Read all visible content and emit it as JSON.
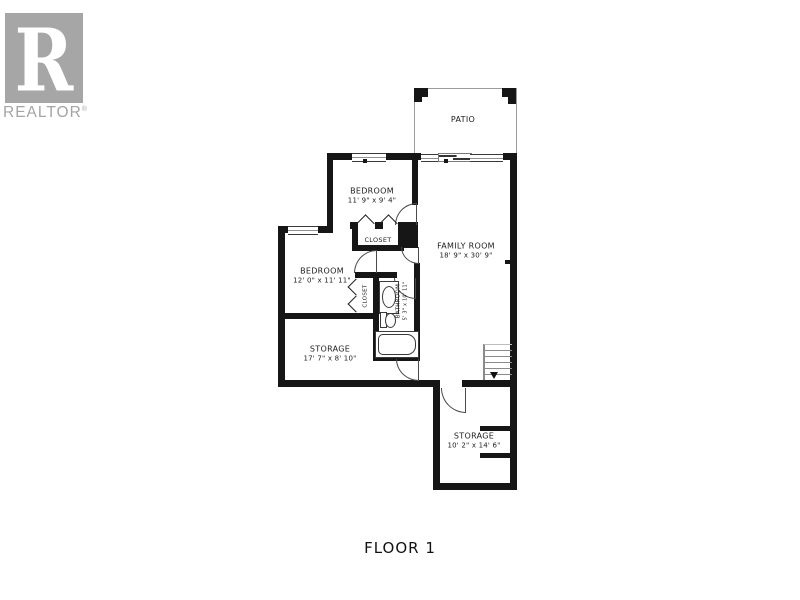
{
  "logo": {
    "letter": "R",
    "brand": "REALTOR",
    "registered": "®"
  },
  "plan": {
    "floor_label": "FLOOR 1",
    "rooms": {
      "patio": {
        "name": "PATIO",
        "dims": ""
      },
      "bedroom_top": {
        "name": "BEDROOM",
        "dims": "11' 9\" x 9' 4\""
      },
      "family_room": {
        "name": "FAMILY ROOM",
        "dims": "18' 9\" x 30' 9\""
      },
      "closet_hall": {
        "name": "CLOSET",
        "dims": ""
      },
      "bedroom_left": {
        "name": "BEDROOM",
        "dims": "12' 0\" x 11' 11\""
      },
      "closet_bedroom": {
        "name": "CLOSET",
        "dims": ""
      },
      "bathroom": {
        "name": "BATHROOM",
        "dims": "5' 3\" x 10' 11\""
      },
      "storage_left": {
        "name": "STORAGE",
        "dims": "17' 7\" x 8' 10\""
      },
      "storage_bottom": {
        "name": "STORAGE",
        "dims": "10' 2\" x 14' 6\""
      }
    }
  },
  "colors": {
    "wall": "#161616",
    "logo_gray": "#a6a6a6",
    "thin_line": "#8a8a8a"
  }
}
